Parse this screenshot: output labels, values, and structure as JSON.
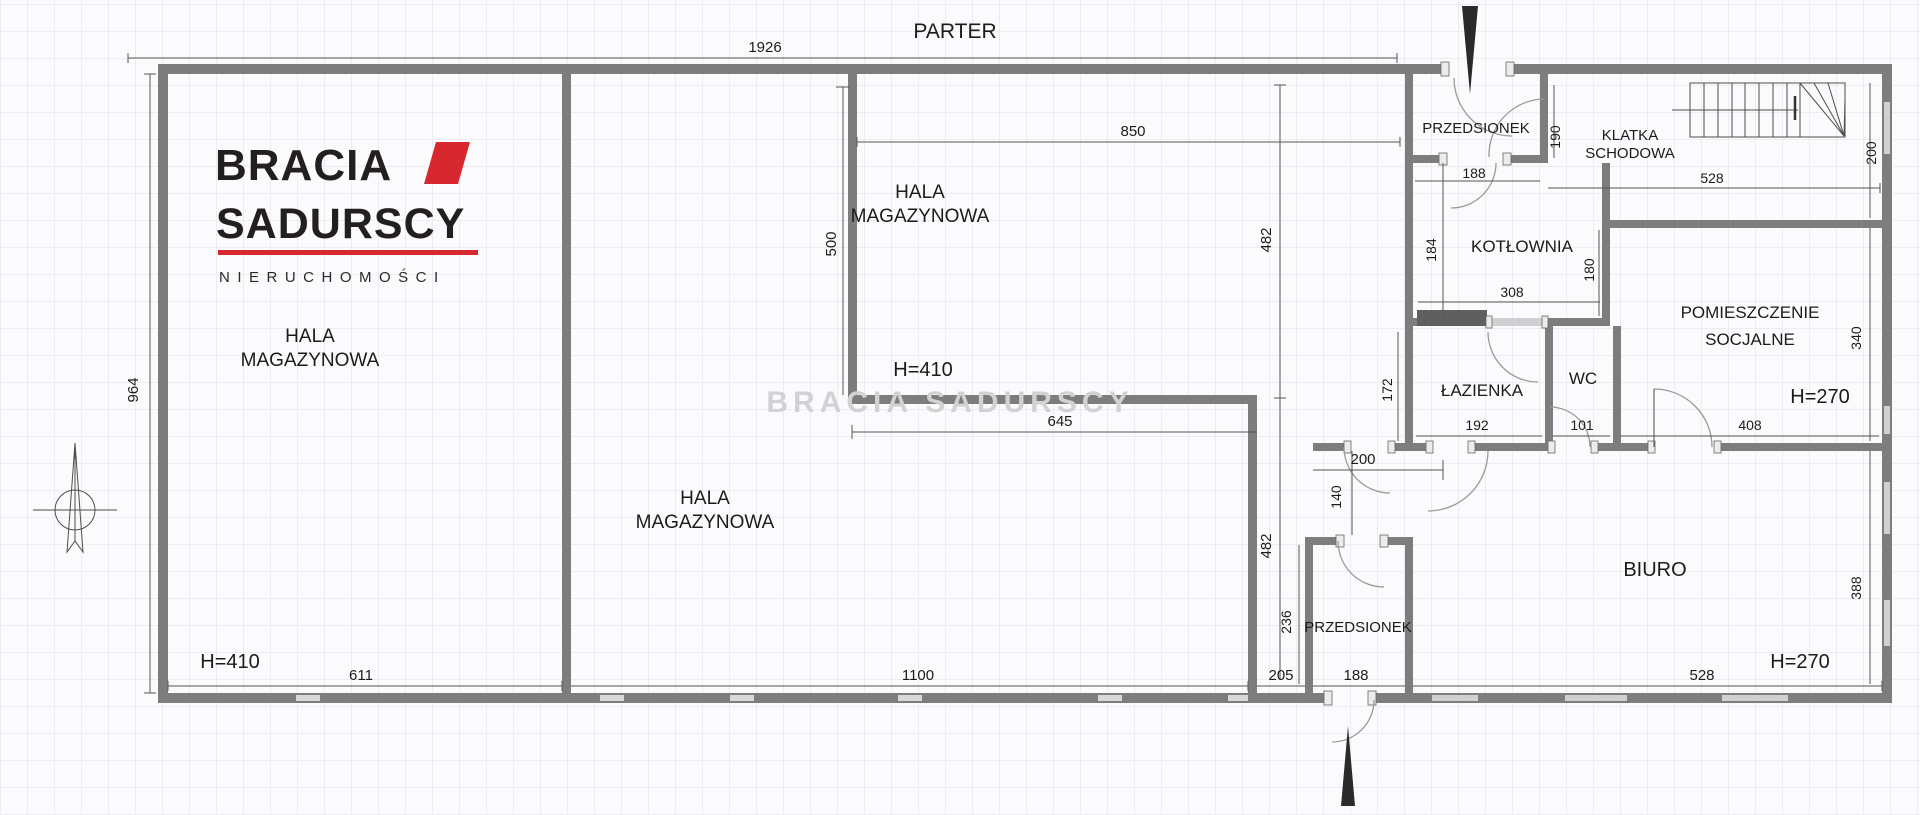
{
  "title": "PARTER",
  "logo": {
    "brand_line1": "BRACIA",
    "brand_line2": "SADURSCY",
    "brand_line3": "NIERUCHOMOŚCI",
    "accent_color": "#d7282f",
    "text_color": "#231f20"
  },
  "watermark": "BRACIA SADURSCY",
  "colors": {
    "wall": "#7d7d7d",
    "wall_dark": "#5f5f5f",
    "dimension_line": "#555555",
    "text": "#1b1b1b",
    "window": "#cfd0d2",
    "grid": "#ededf1",
    "watermark": "#d2d2d5",
    "logo_red": "#d7282f"
  },
  "rooms": {
    "hala1": {
      "line1": "HALA",
      "line2": "MAGAZYNOWA",
      "height_label": "H=410"
    },
    "hala2": {
      "line1": "HALA",
      "line2": "MAGAZYNOWA",
      "height_label": "H=410"
    },
    "hala3": {
      "line1": "HALA",
      "line2": "MAGAZYNOWA"
    },
    "przedsionek_gorny": {
      "line1": "PRZEDSIONEK",
      "width": "188",
      "height": "190"
    },
    "klatka_schodowa": {
      "line1": "KLATKA",
      "line2": "SCHODOWA",
      "width": "528",
      "height": "200"
    },
    "kotlownia": {
      "line1": "KOTŁOWNIA",
      "width": "308",
      "height": "184",
      "right_dim": "180"
    },
    "pomieszczenie_socjalne": {
      "line1": "POMIESZCZENIE",
      "line2": "SOCJALNE",
      "height_label": "H=270",
      "width": "408",
      "height": "340"
    },
    "lazienka": {
      "line1": "ŁAZIENKA",
      "width": "192",
      "height": "172"
    },
    "wc": {
      "line1": "WC",
      "width": "101"
    },
    "korytarz": {
      "width": "200",
      "height": "140"
    },
    "przedsionek_dolny": {
      "line1": "PRZEDSIONEK",
      "width": "188",
      "height": "236"
    },
    "biuro": {
      "line1": "BIURO",
      "height_label": "H=270",
      "width": "528",
      "height": "388"
    }
  },
  "dimensions": {
    "total_width": "1926",
    "left_height": "964",
    "hala2_top": "850",
    "hala2_left": "500",
    "right_upper": "482",
    "right_lower": "482",
    "hala3_top": "645",
    "hala1_bottom": "611",
    "hala3_bottom": "1100",
    "passage_bottom": "205"
  }
}
